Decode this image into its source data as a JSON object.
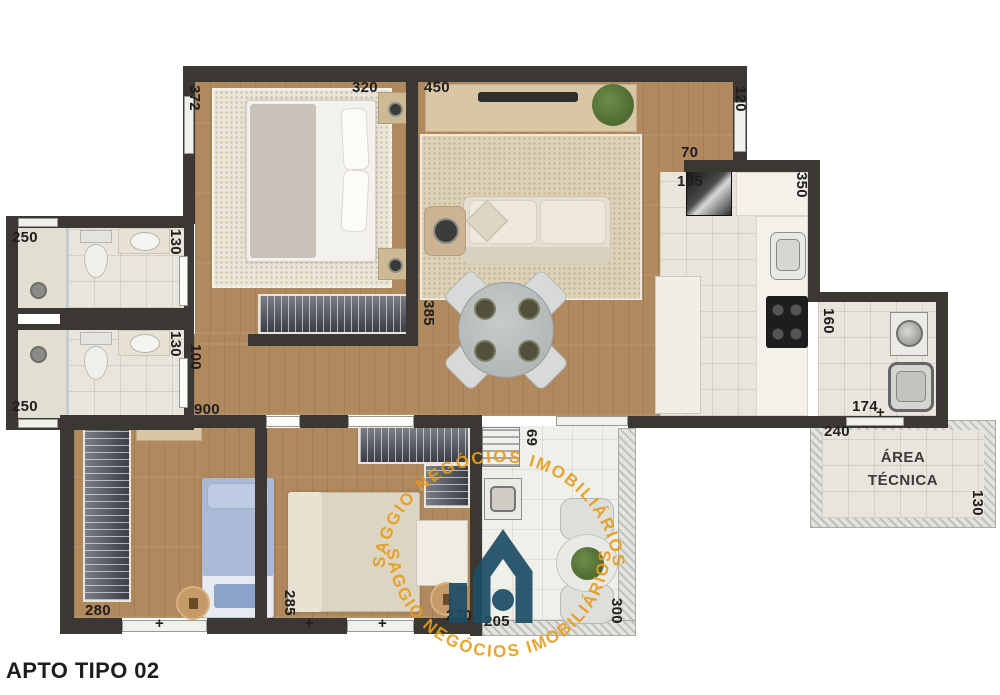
{
  "title": "APTO TIPO 02",
  "watermark": {
    "text": "SAGGIO NEGÓCIOS IMOBILIÁRIOS"
  },
  "area_tecnica": {
    "line1": "ÁREA",
    "line2": "TÉCNICA"
  },
  "glyphs": {
    "tick": "+"
  },
  "colors": {
    "wall": "#3B3733",
    "wood_floor": "#B1895F",
    "tile_floor": "#EAE5DC",
    "watermark_orange": "#E69C1C",
    "logo_navy": "#1E4E66"
  },
  "dims": {
    "d372": "372",
    "d320": "320",
    "d450": "450",
    "d120": "120",
    "d70": "70",
    "d185": "185",
    "d350": "350",
    "d160": "160",
    "d174": "174",
    "d240": "240",
    "d130a": "130",
    "d130b": "130",
    "d130c": "130",
    "d250a": "250",
    "d250b": "250",
    "d100": "100",
    "d900": "900",
    "d385": "385",
    "d280": "280",
    "d285": "285",
    "d270": "270",
    "d205": "205",
    "d69": "69",
    "d300": "300"
  }
}
